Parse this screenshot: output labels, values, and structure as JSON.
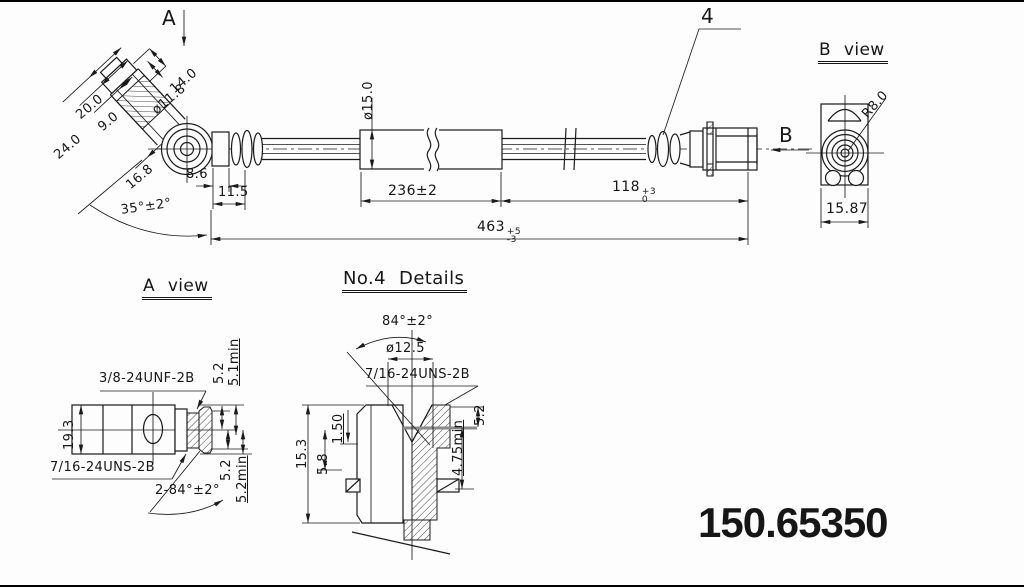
{
  "part_number": "150.65350",
  "main_view": {
    "labels": {
      "section_a": "A",
      "detail_callout": "4",
      "direction_b": "B"
    },
    "dims": {
      "head_width": "14.0",
      "eye_dia": "ø11.8",
      "banjo_width": "20.0",
      "arm_inner": "9.0",
      "banjo_overall": "24.0",
      "eye_offset": "16.8",
      "collar_len": "8.6",
      "end_len": "11.5",
      "bend_angle": "35°±2°",
      "sleeve_dia": "ø15.0",
      "sleeve_len": "236±2",
      "len118": "118",
      "len118_plus": "+3",
      "len118_minus": "0",
      "len463": "463",
      "len463_plus": "+5",
      "len463_minus": "-3"
    }
  },
  "b_view": {
    "title": "B view",
    "dims": {
      "radius": "R8.0",
      "width": "15.87"
    }
  },
  "a_view": {
    "title": "A view",
    "dims": {
      "thread_top": "3/8-24UNF-2B",
      "height": "19.3",
      "thread_bottom": "7/16-24UNS-2B",
      "chamfer": "2-84°±2°",
      "top_52": "5.2",
      "top_51min": "5.1min",
      "bot_52": "5.2",
      "bot_52min": "5.2min"
    }
  },
  "no4_details": {
    "title": "No.4 Details",
    "dims": {
      "flare_angle": "84°±2°",
      "bore_dia": "ø12.5",
      "thread": "7/16-24UNS-2B",
      "body_h": "15.3",
      "lip": "1.50",
      "depth": "5.8",
      "seat": "5.2",
      "thread_min": "4.75min"
    }
  }
}
